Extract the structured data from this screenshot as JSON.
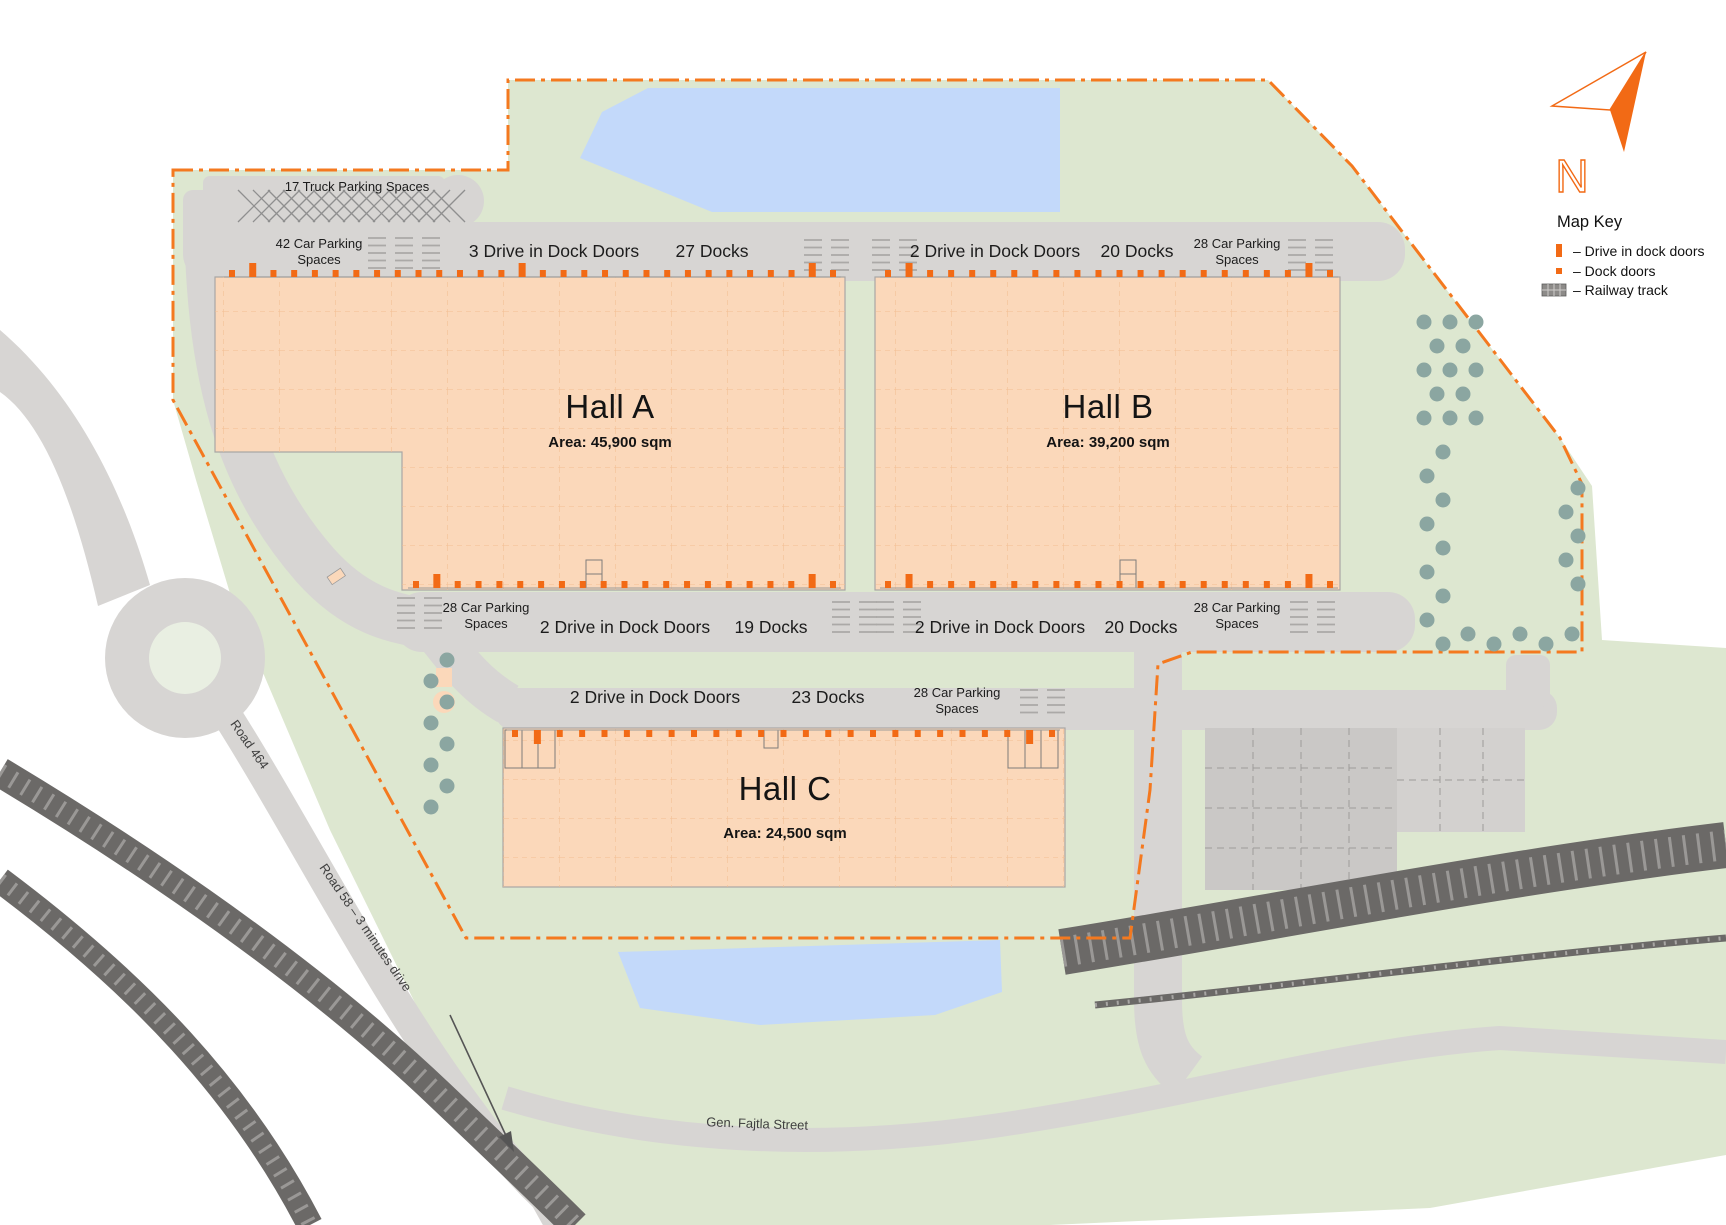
{
  "map": {
    "compass_letter": "N",
    "key": {
      "title": "Map Key",
      "items": {
        "drive_in": "– Drive in dock doors",
        "dock": "– Dock doors",
        "railway": "– Railway track"
      }
    },
    "truck_parking_label": "17 Truck Parking Spaces",
    "car_parking_42": {
      "line1": "42 Car Parking",
      "line2": "Spaces"
    },
    "halls": {
      "a": {
        "title": "Hall A",
        "area": "Area: 45,900 sqm",
        "top": {
          "drive": "3 Drive in Dock Doors",
          "docks": "27 Docks"
        },
        "bottom": {
          "park_l1": "28 Car Parking",
          "park_l2": "Spaces",
          "drive": "2 Drive in Dock Doors",
          "docks": "19 Docks"
        },
        "counts": {
          "top_docks": 27,
          "top_drive": 3,
          "bottom_docks": 19,
          "bottom_drive": 2
        }
      },
      "b": {
        "title": "Hall B",
        "area": "Area: 39,200 sqm",
        "top": {
          "drive": "2 Drive in Dock Doors",
          "docks": "20 Docks",
          "park_l1": "28 Car Parking",
          "park_l2": "Spaces"
        },
        "bottom": {
          "drive": "2 Drive in Dock Doors",
          "docks": "20 Docks",
          "park_l1": "28 Car Parking",
          "park_l2": "Spaces"
        },
        "counts": {
          "top_docks": 20,
          "top_drive": 2,
          "bottom_docks": 20,
          "bottom_drive": 2
        }
      },
      "c": {
        "title": "Hall C",
        "area": "Area: 24,500 sqm",
        "top": {
          "drive": "2 Drive in Dock Doors",
          "docks": "23 Docks",
          "park_l1": "28 Car Parking",
          "park_l2": "Spaces"
        },
        "counts": {
          "top_docks": 23,
          "top_drive": 2
        }
      }
    },
    "roads": {
      "road464": "Road 464",
      "road58": "Road 58 – 3 minutes drive",
      "fajtla": "Gen. Fajtla Street"
    },
    "colors": {
      "accent_orange": "#F26A15",
      "boundary_orange": "#F4791F",
      "hall_fill": "#FBD8BA",
      "site_green": "#DDE7D0",
      "road_gray": "#D7D5D3",
      "dark_road": "#6B6967",
      "pond_blue": "#C3D9FA",
      "tree": "#8BA6A1"
    }
  }
}
